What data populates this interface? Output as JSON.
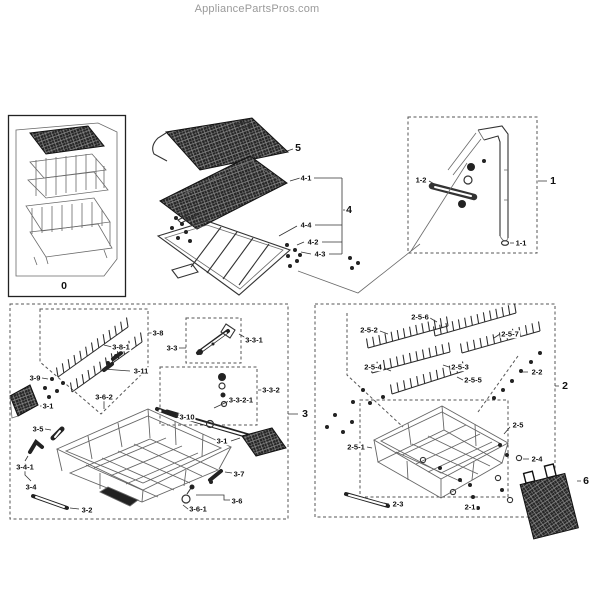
{
  "header": {
    "brand": "AppliancePartsPros.com"
  },
  "colors": {
    "line": "#333333",
    "label": "#111111",
    "brand_gray": "#9a9a9a",
    "background": "#ffffff"
  },
  "diagram": {
    "labels": [
      {
        "text": "0",
        "x": 64,
        "y": 286
      },
      {
        "text": "5",
        "x": 298,
        "y": 148
      },
      {
        "text": "4-1",
        "x": 306,
        "y": 178
      },
      {
        "text": "4",
        "x": 349,
        "y": 210
      },
      {
        "text": "4-4",
        "x": 306,
        "y": 225
      },
      {
        "text": "4-2",
        "x": 313,
        "y": 242
      },
      {
        "text": "4-3",
        "x": 320,
        "y": 254
      },
      {
        "text": "1",
        "x": 553,
        "y": 181
      },
      {
        "text": "1-2",
        "x": 421,
        "y": 180
      },
      {
        "text": "1-1",
        "x": 521,
        "y": 243
      },
      {
        "text": "3",
        "x": 305,
        "y": 414
      },
      {
        "text": "3-8",
        "x": 158,
        "y": 333
      },
      {
        "text": "3-8-1",
        "x": 121,
        "y": 347
      },
      {
        "text": "3-11",
        "x": 141,
        "y": 371
      },
      {
        "text": "3-9",
        "x": 35,
        "y": 378
      },
      {
        "text": "3-1",
        "x": 48,
        "y": 406
      },
      {
        "text": "3-6-2",
        "x": 104,
        "y": 397
      },
      {
        "text": "3-3",
        "x": 172,
        "y": 348
      },
      {
        "text": "3-3-1",
        "x": 254,
        "y": 340
      },
      {
        "text": "3-3-2",
        "x": 271,
        "y": 390
      },
      {
        "text": "3-3-2-1",
        "x": 241,
        "y": 400
      },
      {
        "text": "3-10",
        "x": 187,
        "y": 417
      },
      {
        "text": "3-1",
        "x": 222,
        "y": 441
      },
      {
        "text": "3-5",
        "x": 38,
        "y": 429
      },
      {
        "text": "3-4-1",
        "x": 25,
        "y": 467
      },
      {
        "text": "3-4",
        "x": 31,
        "y": 487
      },
      {
        "text": "3-2",
        "x": 87,
        "y": 510
      },
      {
        "text": "3-7",
        "x": 239,
        "y": 474
      },
      {
        "text": "3-6",
        "x": 237,
        "y": 501
      },
      {
        "text": "3-6-1",
        "x": 198,
        "y": 509
      },
      {
        "text": "2",
        "x": 565,
        "y": 386
      },
      {
        "text": "2-5-6",
        "x": 420,
        "y": 317
      },
      {
        "text": "2-5-2",
        "x": 369,
        "y": 330
      },
      {
        "text": "2-5-7",
        "x": 510,
        "y": 334
      },
      {
        "text": "2-5-4",
        "x": 373,
        "y": 367
      },
      {
        "text": "2-5-3",
        "x": 460,
        "y": 367
      },
      {
        "text": "2-5-5",
        "x": 473,
        "y": 380
      },
      {
        "text": "2-2",
        "x": 537,
        "y": 372
      },
      {
        "text": "2-5",
        "x": 518,
        "y": 425
      },
      {
        "text": "2-5-1",
        "x": 356,
        "y": 447
      },
      {
        "text": "2-3",
        "x": 398,
        "y": 504
      },
      {
        "text": "2-1",
        "x": 470,
        "y": 507
      },
      {
        "text": "2-4",
        "x": 537,
        "y": 459
      },
      {
        "text": "6",
        "x": 586,
        "y": 481
      }
    ]
  }
}
